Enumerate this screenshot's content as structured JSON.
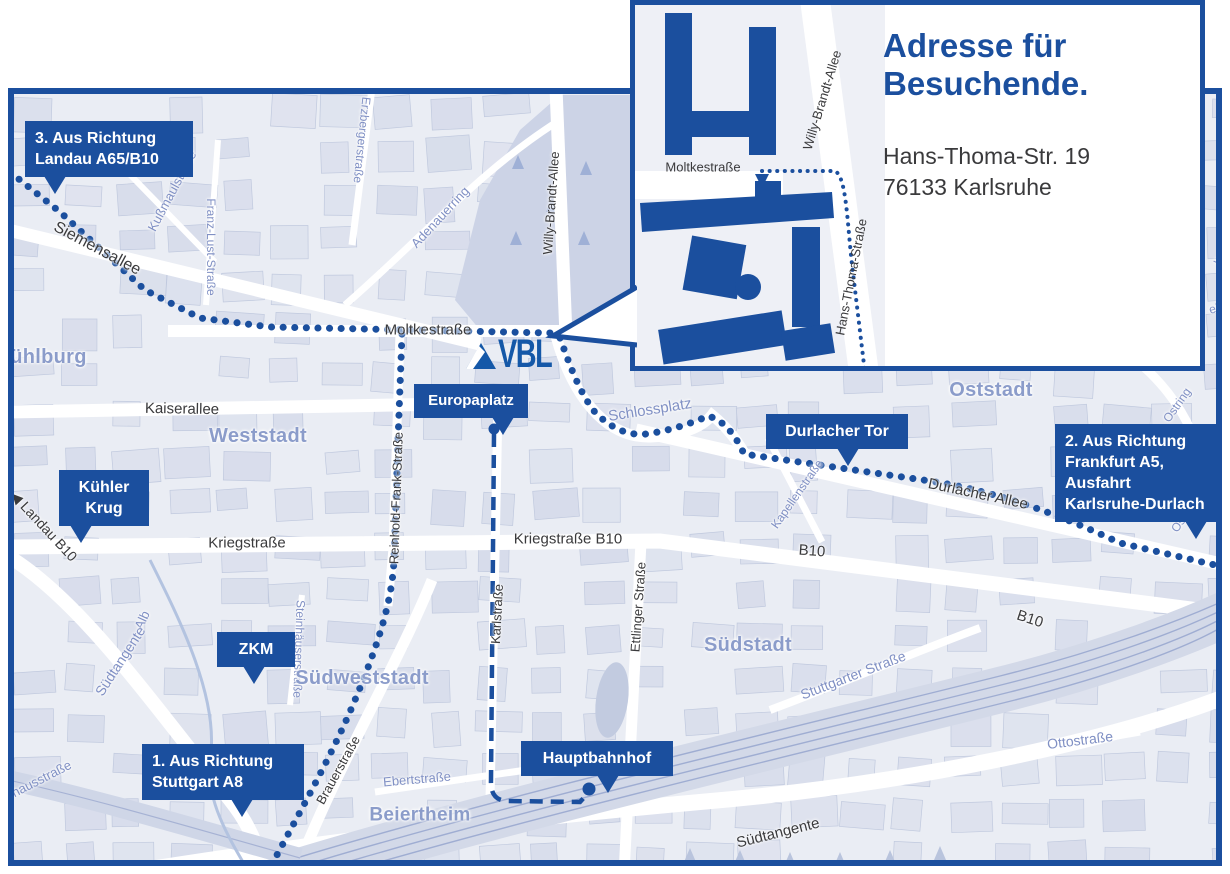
{
  "colors": {
    "primary": "#1b4f9e",
    "logo_blue": "#1558a8",
    "map_bg": "#eaedf4",
    "block": "#d6dbea",
    "park": "#ccd3e6",
    "district_label": "#8b9cca",
    "street_light": "#8090c4",
    "street_dark": "#3a3a3c"
  },
  "logo": {
    "text": "VBL"
  },
  "inset": {
    "title": "Adresse für Besuchende.",
    "address": [
      "Hans-Thoma-Str. 19",
      "76133 Karlsruhe"
    ],
    "street_labels": [
      {
        "id": "moltkestrasse",
        "text": "Moltkestraße",
        "x": 68,
        "y": 162,
        "rot": 0,
        "size": 13
      },
      {
        "id": "willy-brandt-allee",
        "text": "Willy-Brandt-Allee",
        "x": 187,
        "y": 95,
        "rot": -73,
        "size": 13
      },
      {
        "id": "hans-thoma-strasse",
        "text": "Hans-Thoma-Straße",
        "x": 216,
        "y": 272,
        "rot": -79,
        "size": 13
      }
    ]
  },
  "callouts": [
    {
      "id": "route-3",
      "lines": [
        "3. Aus Richtung",
        "Landau A65/B10"
      ],
      "x": 25,
      "y": 121,
      "w": 148,
      "size": 16,
      "tailx": 18
    },
    {
      "id": "kuehler-krug",
      "lines": [
        "Kühler",
        "Krug"
      ],
      "x": 59,
      "y": 470,
      "w": 70,
      "size": 16,
      "tailx": 24,
      "center": true
    },
    {
      "id": "zkm",
      "lines": [
        "ZKM"
      ],
      "x": 217,
      "y": 632,
      "w": 58,
      "size": 16,
      "tailx": 48,
      "center": true
    },
    {
      "id": "europaplatz",
      "lines": [
        "Europaplatz"
      ],
      "x": 414,
      "y": 384,
      "w": 94,
      "size": 15,
      "tailx": 78,
      "center": true
    },
    {
      "id": "durlacher-tor",
      "lines": [
        "Durlacher Tor"
      ],
      "x": 766,
      "y": 414,
      "w": 122,
      "size": 16,
      "tailx": 58,
      "center": true
    },
    {
      "id": "route-2",
      "lines": [
        "2. Aus Richtung",
        "Frankfurt A5,",
        "Ausfahrt",
        "Karlsruhe-Durlach"
      ],
      "x": 1055,
      "y": 424,
      "w": 152,
      "size": 16,
      "tailx": 82
    },
    {
      "id": "hauptbahnhof",
      "lines": [
        "Hauptbahnhof"
      ],
      "x": 521,
      "y": 741,
      "w": 132,
      "size": 16,
      "tailx": 57,
      "center": true
    },
    {
      "id": "route-1",
      "lines": [
        "1. Aus Richtung",
        "Stuttgart A8"
      ],
      "x": 142,
      "y": 744,
      "w": 142,
      "size": 16,
      "tailx": 62
    }
  ],
  "map_labels": [
    {
      "id": "siemensallee",
      "text": "Siemensallee",
      "kind": "dark",
      "x": 97,
      "y": 249,
      "rot": 28,
      "size": 16
    },
    {
      "id": "moltkestrasse",
      "text": "Moltkestraße",
      "kind": "dark",
      "x": 428,
      "y": 330,
      "rot": 0,
      "size": 15
    },
    {
      "id": "kaiserallee",
      "text": "Kaiserallee",
      "kind": "dark",
      "x": 182,
      "y": 409,
      "rot": 1,
      "size": 15
    },
    {
      "id": "kriegstrasse",
      "text": "Kriegstraße",
      "kind": "dark",
      "x": 247,
      "y": 543,
      "rot": 0,
      "size": 15
    },
    {
      "id": "kriegstrasse-b10",
      "text": "Kriegstraße B10",
      "kind": "dark",
      "x": 568,
      "y": 539,
      "rot": 0,
      "size": 15
    },
    {
      "id": "durlacher-allee",
      "text": "Durlacher Allee",
      "kind": "dark",
      "x": 978,
      "y": 494,
      "rot": 12,
      "size": 15
    },
    {
      "id": "b10-west",
      "text": "B10",
      "kind": "dark",
      "x": 812,
      "y": 551,
      "rot": 4,
      "size": 15
    },
    {
      "id": "b10-east",
      "text": "B10",
      "kind": "dark",
      "x": 1030,
      "y": 619,
      "rot": 18,
      "size": 15
    },
    {
      "id": "landau-b10",
      "text": "◀ Landau B10",
      "kind": "dark",
      "x": 44,
      "y": 526,
      "rot": 47,
      "size": 14
    },
    {
      "id": "willy-brandt-allee",
      "text": "Willy-Brandt-Allee",
      "kind": "dark",
      "x": 551,
      "y": 203,
      "rot": -86,
      "size": 13
    },
    {
      "id": "reinhold-frank-strasse",
      "text": "Reinhold-Frank-Straße",
      "kind": "dark",
      "x": 396,
      "y": 498,
      "rot": -88,
      "size": 13
    },
    {
      "id": "karlstrasse",
      "text": "Karlstraße",
      "kind": "dark",
      "x": 497,
      "y": 614,
      "rot": -87,
      "size": 13
    },
    {
      "id": "ettlinger-strasse",
      "text": "Ettlinger Straße",
      "kind": "dark",
      "x": 638,
      "y": 607,
      "rot": -86,
      "size": 13
    },
    {
      "id": "brauerstrasse",
      "text": "Brauerstraße",
      "kind": "dark",
      "x": 338,
      "y": 770,
      "rot": -61,
      "size": 13
    },
    {
      "id": "suedtangente-sued",
      "text": "Südtangente",
      "kind": "dark",
      "x": 778,
      "y": 833,
      "rot": -14,
      "size": 15
    },
    {
      "id": "kussmaulstrasse",
      "text": "Kußmaulstraße",
      "kind": "light",
      "x": 172,
      "y": 191,
      "rot": -62,
      "size": 13
    },
    {
      "id": "franz-lust-strasse",
      "text": "Franz-Lust-Straße",
      "kind": "light",
      "x": 211,
      "y": 247,
      "rot": 90,
      "size": 12
    },
    {
      "id": "erzbergerstrasse",
      "text": "Erzbergerstraße",
      "kind": "light",
      "x": 362,
      "y": 140,
      "rot": 96,
      "size": 12
    },
    {
      "id": "adenauerring",
      "text": "Adenauerring",
      "kind": "light",
      "x": 440,
      "y": 217,
      "rot": -47,
      "size": 13
    },
    {
      "id": "schlossplatz",
      "text": "Schlossplatz",
      "kind": "light",
      "x": 650,
      "y": 410,
      "rot": -9,
      "size": 15
    },
    {
      "id": "kapellenstrasse",
      "text": "Kapellenstraße",
      "kind": "light",
      "x": 797,
      "y": 494,
      "rot": -55,
      "size": 12
    },
    {
      "id": "ostring-nord",
      "text": "Ostring",
      "kind": "light",
      "x": 1177,
      "y": 405,
      "rot": -55,
      "size": 12
    },
    {
      "id": "ostring-sued",
      "text": "Ostring",
      "kind": "light",
      "x": 1185,
      "y": 515,
      "rot": -55,
      "size": 12
    },
    {
      "id": "stuttgarter-strasse",
      "text": "Stuttgarter Straße",
      "kind": "light",
      "x": 853,
      "y": 675,
      "rot": -21,
      "size": 14
    },
    {
      "id": "ottostrasse",
      "text": "Ottostraße",
      "kind": "light",
      "x": 1080,
      "y": 740,
      "rot": -7,
      "size": 14
    },
    {
      "id": "ebertstrasse",
      "text": "Ebertstraße",
      "kind": "light",
      "x": 417,
      "y": 779,
      "rot": -5,
      "size": 13
    },
    {
      "id": "alb",
      "text": "Alb",
      "kind": "light",
      "x": 142,
      "y": 620,
      "rot": -65,
      "size": 13
    },
    {
      "id": "suedtangente-west",
      "text": "Südtangente",
      "kind": "light",
      "x": 120,
      "y": 661,
      "rot": -57,
      "size": 14
    },
    {
      "id": "pulverhausstrasse",
      "text": "Pulverhausstraße",
      "kind": "light",
      "x": 25,
      "y": 787,
      "rot": -27,
      "size": 13
    },
    {
      "id": "steinhaeuserstrasse",
      "text": "Steinhäuserstraße",
      "kind": "light",
      "x": 299,
      "y": 649,
      "rot": 92,
      "size": 12
    },
    {
      "id": "fragment-we",
      "text": "we",
      "kind": "light",
      "x": 1220,
      "y": 257,
      "rot": -50,
      "size": 12
    },
    {
      "id": "fragment-ein",
      "text": "ein",
      "kind": "light",
      "x": 1217,
      "y": 308,
      "rot": -15,
      "size": 12
    },
    {
      "id": "muehlburg",
      "text": "Mühlburg",
      "kind": "district",
      "x": 40,
      "y": 357,
      "rot": 0,
      "size": 20
    },
    {
      "id": "weststadt",
      "text": "Weststadt",
      "kind": "district",
      "x": 258,
      "y": 436,
      "rot": 0,
      "size": 20
    },
    {
      "id": "oststadt",
      "text": "Oststadt",
      "kind": "district",
      "x": 991,
      "y": 390,
      "rot": 0,
      "size": 20
    },
    {
      "id": "suedstadt",
      "text": "Südstadt",
      "kind": "district",
      "x": 748,
      "y": 645,
      "rot": 0,
      "size": 20
    },
    {
      "id": "suedweststadt",
      "text": "Südweststadt",
      "kind": "district",
      "x": 362,
      "y": 678,
      "rot": 0,
      "size": 20
    },
    {
      "id": "beiertheim",
      "text": "Beiertheim",
      "kind": "district",
      "x": 420,
      "y": 815,
      "rot": 0,
      "size": 19
    }
  ],
  "poi": [
    {
      "id": "europaplatz-stop",
      "x": 494,
      "y": 429,
      "d": 11
    },
    {
      "id": "hauptbahnhof-stop",
      "x": 589,
      "y": 789,
      "d": 13
    }
  ]
}
